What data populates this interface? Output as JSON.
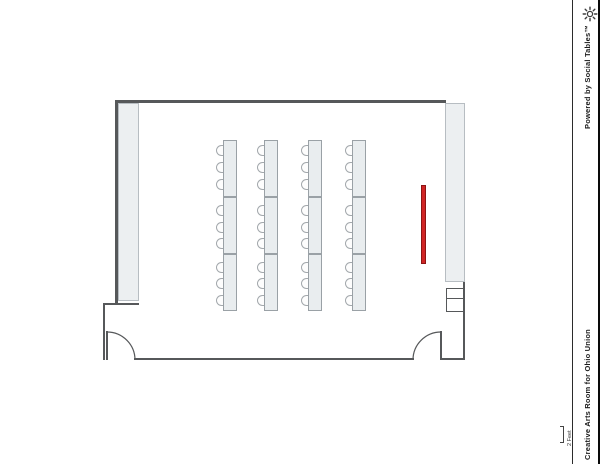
{
  "sidebar": {
    "powered_by": "Powered by Social Tables™",
    "room_title": "Creative Arts Room for Ohio Union",
    "logo_icon": "sun-icon"
  },
  "scale": {
    "label": "2 Feet"
  },
  "colors": {
    "wall": "#56585a",
    "panel_fill": "#eceff1",
    "table_fill": "#e9edef",
    "chair_fill": "#fdfdfd",
    "screen_fill": "#d02525",
    "screen_border": "#8c1414"
  },
  "floorplan": {
    "furniture_summary": {
      "tables": 12,
      "chairs": 36,
      "columns": 4
    },
    "table_columns_x": [
      223,
      264,
      308,
      352
    ],
    "table_width": 14,
    "table_ys": [
      140,
      197,
      254
    ],
    "table_height": 57,
    "chair_ys": [
      145,
      162,
      179,
      205,
      222,
      238,
      262,
      278,
      295
    ],
    "chair_width": 7,
    "chair_height": 11,
    "screen": {
      "x": 421,
      "y": 185,
      "w": 5,
      "h": 79
    }
  }
}
